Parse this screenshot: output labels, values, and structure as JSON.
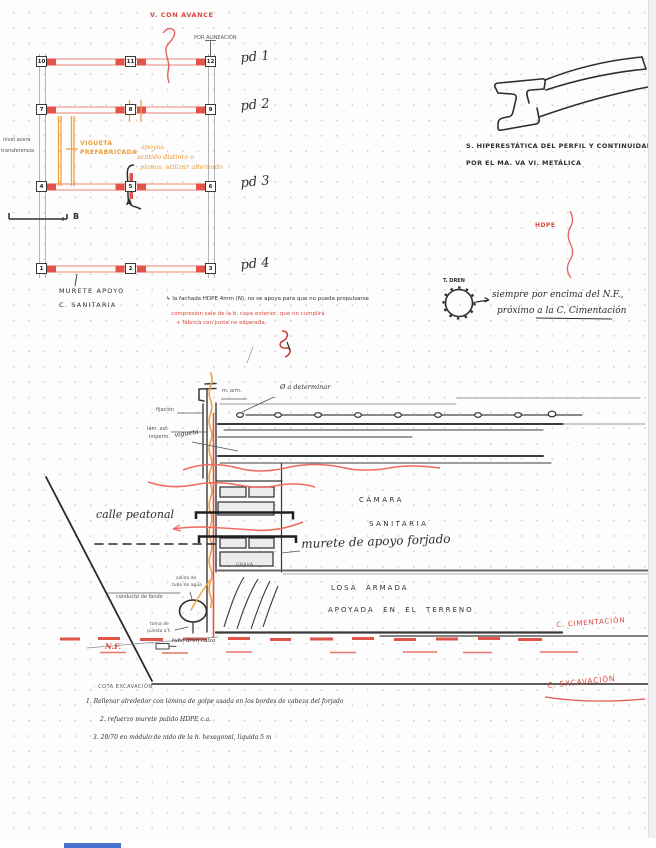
{
  "colors": {
    "ink": "#2e2e2e",
    "red": "#d9493e",
    "orange": "#ef9b32",
    "beam_red": "#e2544a",
    "blue_bar": "#4a72cf"
  },
  "plan": {
    "red_note": "V. CON AVANCE",
    "alignment_note": "POR ALINEACIÓN",
    "porticos": [
      "pd 1",
      "pd 2",
      "pd 3",
      "pd 4"
    ],
    "column_rows": [
      [
        "10",
        "11",
        "12"
      ],
      [
        "7",
        "8",
        "9"
      ],
      [
        "4",
        "5",
        "6"
      ],
      [
        "1",
        "2",
        "3"
      ]
    ],
    "vigueta_label": [
      "VIGUETA",
      "PREFABRICADA"
    ],
    "orange_note": [
      "apoyos",
      "sentido distinto o",
      "planos, utilizar alternado"
    ],
    "left_note": [
      "nivel acera",
      "transferencia"
    ],
    "marker_a": "A",
    "marker_b": "B",
    "murete_label": "MURETE APOYO",
    "sanitaria_label": "C. SANITARIA"
  },
  "ibeam": {
    "caption1": "S. HIPERESTÁTICA DEL PERFIL Y CONTINUIDAD",
    "caption2": "POR EL MA. VA VI. METÁLICA"
  },
  "hdpe_note": "HDPE",
  "dren": {
    "label": "T. DREN",
    "line1": "siempre por encima del N.F.,",
    "line2": "próximo a la C. Cimentación"
  },
  "membrane_note": {
    "black": "↳ la fachada HDPE 4mm (N), no se apoya para que no pueda propulsarse",
    "red1": "compresión sale de la b. capa exterior, que no cumplirá",
    "red2": "+ fábrica con junta no esperada,"
  },
  "section": {
    "m_arm": "m. arm.",
    "diam_note": "Ø a determinar",
    "fijacion": "fijación",
    "lam1": "lám. asf.",
    "lam2": "imperm.",
    "vigueta": "vigueta",
    "camara": "CÁMARA",
    "sanitaria": "SANITARIA",
    "calle": "calle peatonal",
    "murete": "murete de apoyo forjado",
    "grava": "GRAVA",
    "losa1": "LOSA  ARMADA",
    "losa2": "APOYADA  EN  EL  TERRENO",
    "c_cimentacion": "C. CIMENTACIÓN",
    "c_excavacion": "C. EXCAVACIÓN",
    "salida1": "salida de",
    "salida2": "tubo de agua",
    "conducto": "conducto de fondo",
    "toma1": "toma de",
    "toma2": "puesta a t.",
    "nf": "N.F.",
    "tubo_dren": "tubo dren calza"
  },
  "notes": {
    "title": "· COTA EXCAVACIÓN",
    "n1": "1. Rellenar alrededor con lámina de golpe usada en los bordes de cabeza del forjado",
    "n2": "2. refuerzo murete pulido HDPE c.a.",
    "n3": "3. 20/70 en módulo de nido de la h. hexagonal, líquida 5 m"
  }
}
